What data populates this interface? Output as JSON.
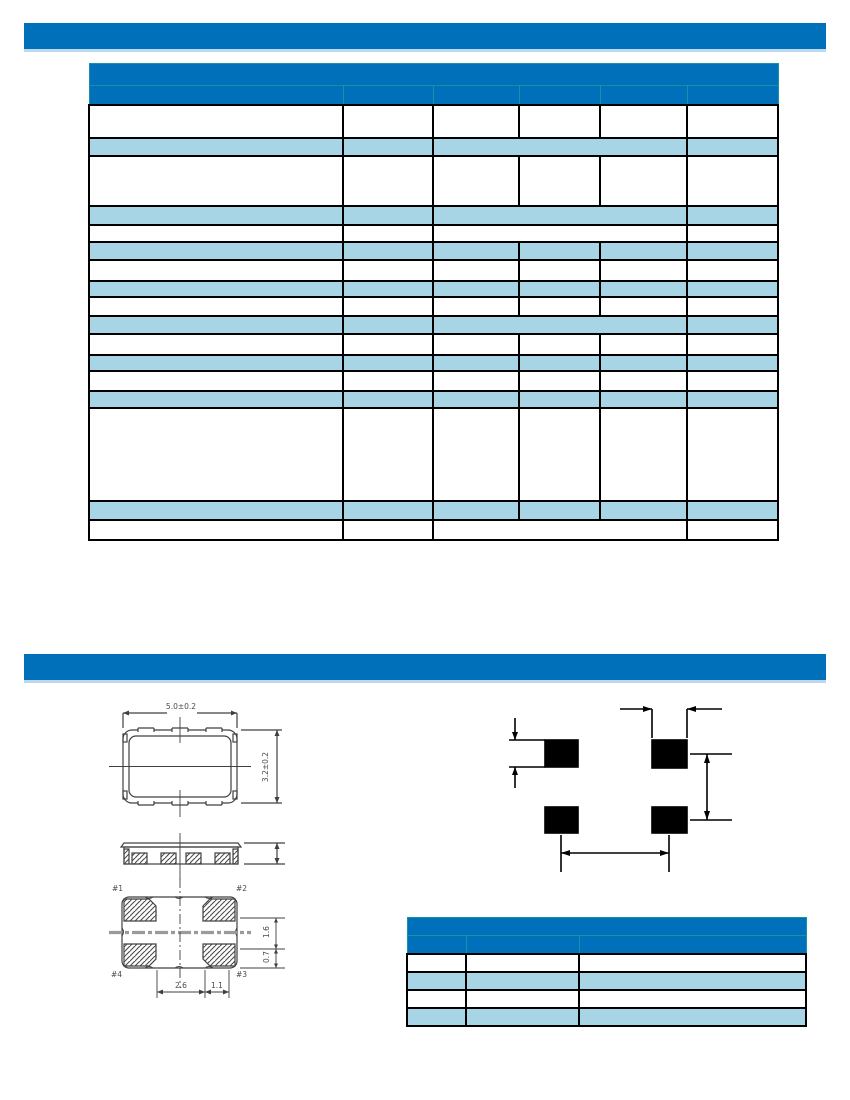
{
  "colors": {
    "brand_blue": "#0070ba",
    "row_light_blue": "#a8d5e6",
    "bar_underline": "#bcd9ee",
    "teal_border": "#1593a5",
    "grid_black": "#000000",
    "drawing_line": "#404040",
    "centerline_gray": "#9a9a9a"
  },
  "top_bar": {
    "text": ""
  },
  "section2_bar": {
    "text": ""
  },
  "spec_table": {
    "title": "",
    "col_widths": [
      254,
      90,
      86,
      81,
      87,
      91
    ],
    "rows": [
      {
        "h": 22,
        "bg": "blue",
        "spans": [
          6
        ],
        "cells": [
          ""
        ]
      },
      {
        "h": 19,
        "bg": "blue",
        "spans": [
          1,
          1,
          1,
          1,
          1,
          1
        ],
        "cells": [
          "",
          "",
          "",
          "",
          "",
          ""
        ]
      },
      {
        "h": 33,
        "bg": "white",
        "spans": [
          1,
          1,
          1,
          1,
          1,
          1
        ],
        "cells": [
          "",
          "",
          "",
          "",
          "",
          ""
        ]
      },
      {
        "h": 18,
        "bg": "lb",
        "spans": [
          1,
          1,
          3,
          1
        ],
        "cells": [
          "",
          "",
          "",
          ""
        ]
      },
      {
        "h": 50,
        "bg": "white",
        "spans": [
          1,
          1,
          1,
          1,
          1,
          1
        ],
        "cells": [
          "",
          "",
          "",
          "",
          "",
          ""
        ]
      },
      {
        "h": 19,
        "bg": "lb",
        "spans": [
          1,
          1,
          3,
          1
        ],
        "cells": [
          "",
          "",
          "",
          ""
        ]
      },
      {
        "h": 17,
        "bg": "white",
        "spans": [
          1,
          1,
          3,
          1
        ],
        "cells": [
          "",
          "",
          "",
          ""
        ]
      },
      {
        "h": 18,
        "bg": "lb",
        "spans": [
          1,
          1,
          1,
          1,
          1,
          1
        ],
        "cells": [
          "",
          "",
          "",
          "",
          "",
          ""
        ]
      },
      {
        "h": 21,
        "bg": "white",
        "spans": [
          1,
          1,
          1,
          1,
          1,
          1
        ],
        "cells": [
          "",
          "",
          "",
          "",
          "",
          ""
        ]
      },
      {
        "h": 16,
        "bg": "lb",
        "spans": [
          1,
          1,
          1,
          1,
          1,
          1
        ],
        "cells": [
          "",
          "",
          "",
          "",
          "",
          ""
        ]
      },
      {
        "h": 19,
        "bg": "white",
        "spans": [
          1,
          1,
          1,
          1,
          1,
          1
        ],
        "cells": [
          "",
          "",
          "",
          "",
          "",
          ""
        ]
      },
      {
        "h": 18,
        "bg": "lb",
        "spans": [
          1,
          1,
          3,
          1
        ],
        "cells": [
          "",
          "",
          "",
          ""
        ]
      },
      {
        "h": 21,
        "bg": "white",
        "spans": [
          1,
          1,
          1,
          1,
          1,
          1
        ],
        "cells": [
          "",
          "",
          "",
          "",
          "",
          ""
        ]
      },
      {
        "h": 16,
        "bg": "lb",
        "spans": [
          1,
          1,
          1,
          1,
          1,
          1
        ],
        "cells": [
          "",
          "",
          "",
          "",
          "",
          ""
        ]
      },
      {
        "h": 20,
        "bg": "white",
        "spans": [
          1,
          1,
          1,
          1,
          1,
          1
        ],
        "cells": [
          "",
          "",
          "",
          "",
          "",
          ""
        ]
      },
      {
        "h": 17,
        "bg": "lb",
        "spans": [
          1,
          1,
          1,
          1,
          1,
          1
        ],
        "cells": [
          "",
          "",
          "",
          "",
          "",
          ""
        ]
      },
      {
        "h": 93,
        "bg": "white",
        "spans": [
          1,
          1,
          1,
          1,
          1,
          1
        ],
        "cells": [
          "",
          "",
          "",
          "",
          "",
          ""
        ]
      },
      {
        "h": 19,
        "bg": "lb",
        "spans": [
          1,
          1,
          1,
          1,
          1,
          1
        ],
        "cells": [
          "",
          "",
          "",
          "",
          "",
          ""
        ]
      },
      {
        "h": 20,
        "bg": "white",
        "spans": [
          1,
          1,
          3,
          1
        ],
        "cells": [
          "",
          "",
          "",
          ""
        ]
      }
    ]
  },
  "pin_table": {
    "title": "",
    "col_widths": [
      59,
      113,
      227
    ],
    "rows": [
      {
        "h": 18,
        "bg": "blue",
        "spans": [
          3
        ],
        "cells": [
          ""
        ]
      },
      {
        "h": 18,
        "bg": "blue",
        "spans": [
          1,
          1,
          1
        ],
        "cells": [
          "",
          "",
          ""
        ]
      },
      {
        "h": 18,
        "bg": "white",
        "spans": [
          1,
          1,
          1
        ],
        "cells": [
          "",
          "",
          ""
        ]
      },
      {
        "h": 18,
        "bg": "lb",
        "spans": [
          1,
          1,
          1
        ],
        "cells": [
          "",
          "",
          ""
        ]
      },
      {
        "h": 18,
        "bg": "white",
        "spans": [
          1,
          1,
          1
        ],
        "cells": [
          "",
          "",
          ""
        ]
      },
      {
        "h": 18,
        "bg": "lb",
        "spans": [
          1,
          1,
          1
        ],
        "cells": [
          "",
          "",
          ""
        ]
      }
    ]
  },
  "drawings": {
    "top_view": {
      "width_label": "5.0±0.2",
      "height_label": "3.2±0.2"
    },
    "bottom_view": {
      "pin1": "#1",
      "pin2": "#2",
      "pin3": "#3",
      "pin4": "#4",
      "dim_gap": "1.6",
      "dim_pad_height": "0.7",
      "dim_inner": "2.6",
      "dim_edge": "1.1"
    }
  }
}
